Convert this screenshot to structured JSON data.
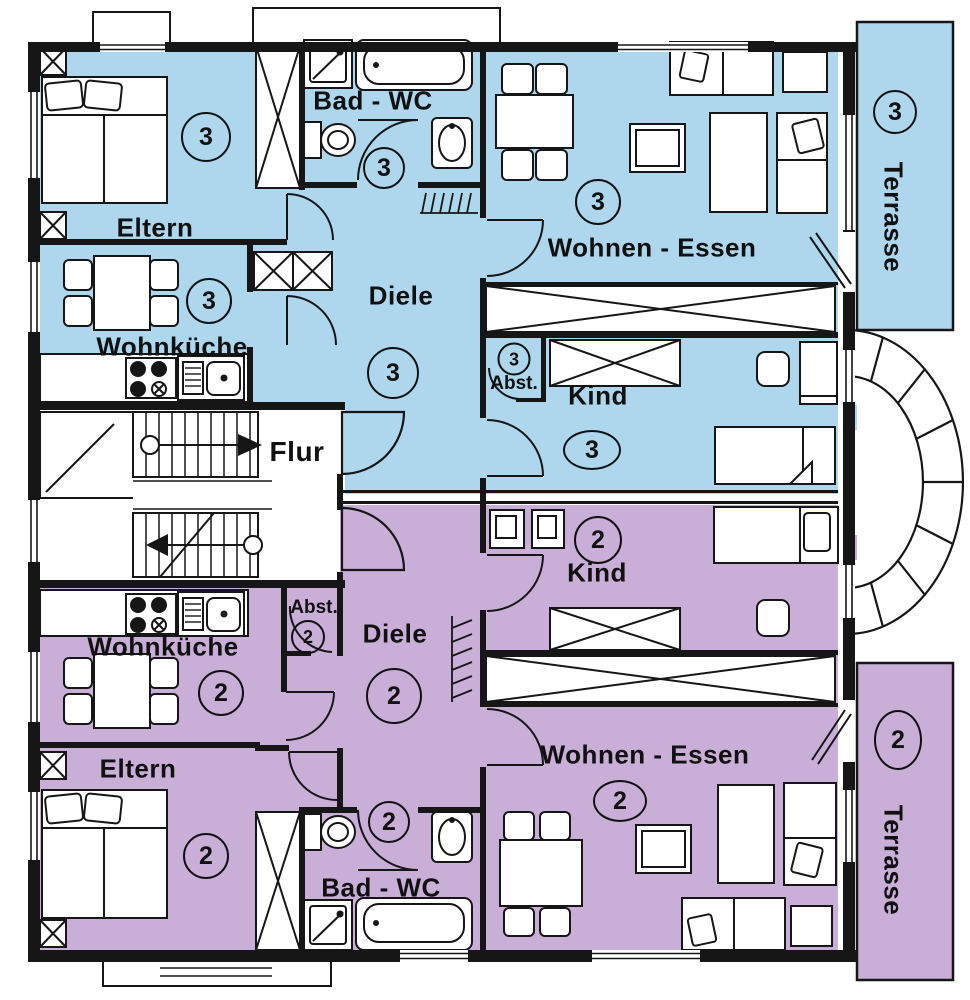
{
  "plan": {
    "background": "#ffffff",
    "line_color": "#161616",
    "stairwell": {
      "label": "Flur"
    },
    "apartment_3": {
      "number": "3",
      "color": "#aed6ec",
      "rooms": {
        "eltern": "Eltern",
        "wohnkueche": "Wohnküche",
        "bad_wc": "Bad - WC",
        "diele": "Diele",
        "abstellraum": "Abst.",
        "kind": "Kind",
        "wohnen_essen": "Wohnen - Essen",
        "terrasse": "Terrasse"
      }
    },
    "apartment_2": {
      "number": "2",
      "color": "#c9aed8",
      "rooms": {
        "eltern": "Eltern",
        "wohnkueche": "Wohnküche",
        "bad_wc": "Bad - WC",
        "diele": "Diele",
        "abstellraum": "Abst.",
        "kind": "Kind",
        "wohnen_essen": "Wohnen - Essen",
        "terrasse": "Terrasse"
      }
    }
  }
}
